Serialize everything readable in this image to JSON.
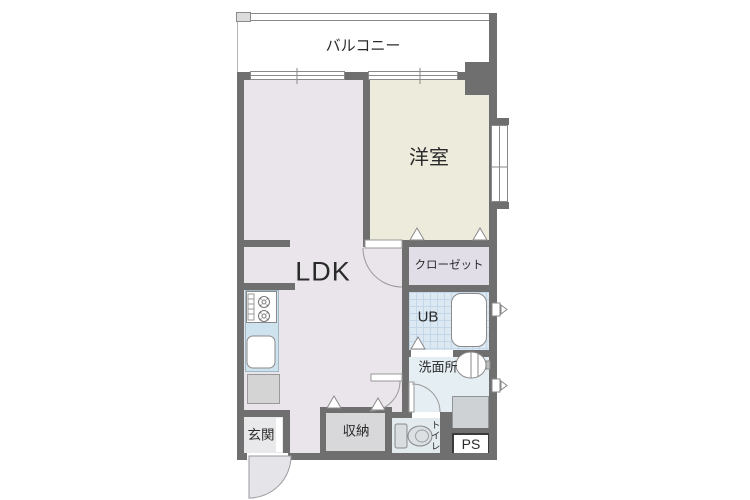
{
  "meta": {
    "type": "apartment-floor-plan",
    "orientation": "1K/1LDK unit, balcony at top"
  },
  "rooms": {
    "balcony": {
      "label": "バルコニー"
    },
    "western_room": {
      "label": "洋室"
    },
    "ldk": {
      "label": "LDK"
    },
    "closet": {
      "label": "クローゼット"
    },
    "unit_bath": {
      "label": "UB"
    },
    "washroom": {
      "label": "洗面所"
    },
    "toilet": {
      "label": "トイレ"
    },
    "storage": {
      "label": "収納"
    },
    "entrance": {
      "label": "玄関"
    },
    "pipe_space": {
      "label": "PS"
    }
  },
  "fixtures": [
    "kitchen-stove",
    "kitchen-grill",
    "kitchen-sink",
    "refrigerator-space",
    "bathtub",
    "washbasin",
    "washing-machine-space",
    "toilet-fixture",
    "entrance-door",
    "room-doors",
    "windows",
    "vent-markers"
  ],
  "colors": {
    "wall": "#6f6f6f",
    "outline": "#8a8a8a",
    "ldk": "#eae5ea",
    "western_room": "#edebdc",
    "closet": "#e1dee8",
    "unit_bath": "#dce9f2",
    "unit_bath_grid": "#c3d7e8",
    "washroom": "#e4eef3",
    "toilet": "#e4ebef",
    "entrance": "#e9e9eb",
    "storage": "#d8d8da",
    "kitchen_counter": "#cfe3ee",
    "door_swing_fill": "#e4e4e9",
    "text": "#2a2a2a"
  }
}
